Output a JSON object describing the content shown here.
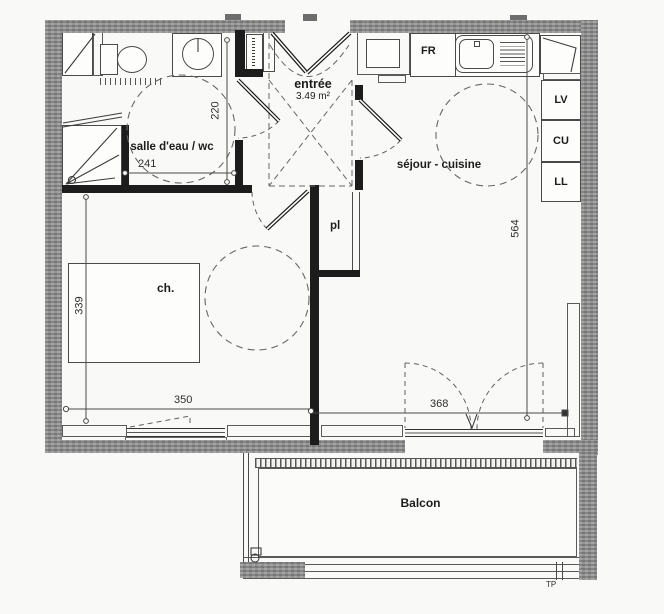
{
  "rooms": {
    "bathroom": "salle d'eau / wc",
    "entry": "entrée",
    "entry_area": "3.49 m²",
    "living_kitchen": "séjour - cuisine",
    "closet": "pl",
    "bedroom": "ch.",
    "balcony": "Balcon"
  },
  "appliances": {
    "fridge": "FR",
    "dishwasher": "LV",
    "cooktop": "CU",
    "washer": "LL"
  },
  "dimensions": {
    "bathroom_width": "241",
    "bathroom_depth": "220",
    "bedroom_depth": "339",
    "bedroom_width": "350",
    "living_width": "368",
    "living_depth": "564"
  },
  "annotations": {
    "plan_ref": "TP"
  },
  "colors": {
    "wall_gray": "#8d8d8d",
    "partition_black": "#1c1c1c",
    "line": "#555555",
    "paper": "#f9f9f7"
  }
}
